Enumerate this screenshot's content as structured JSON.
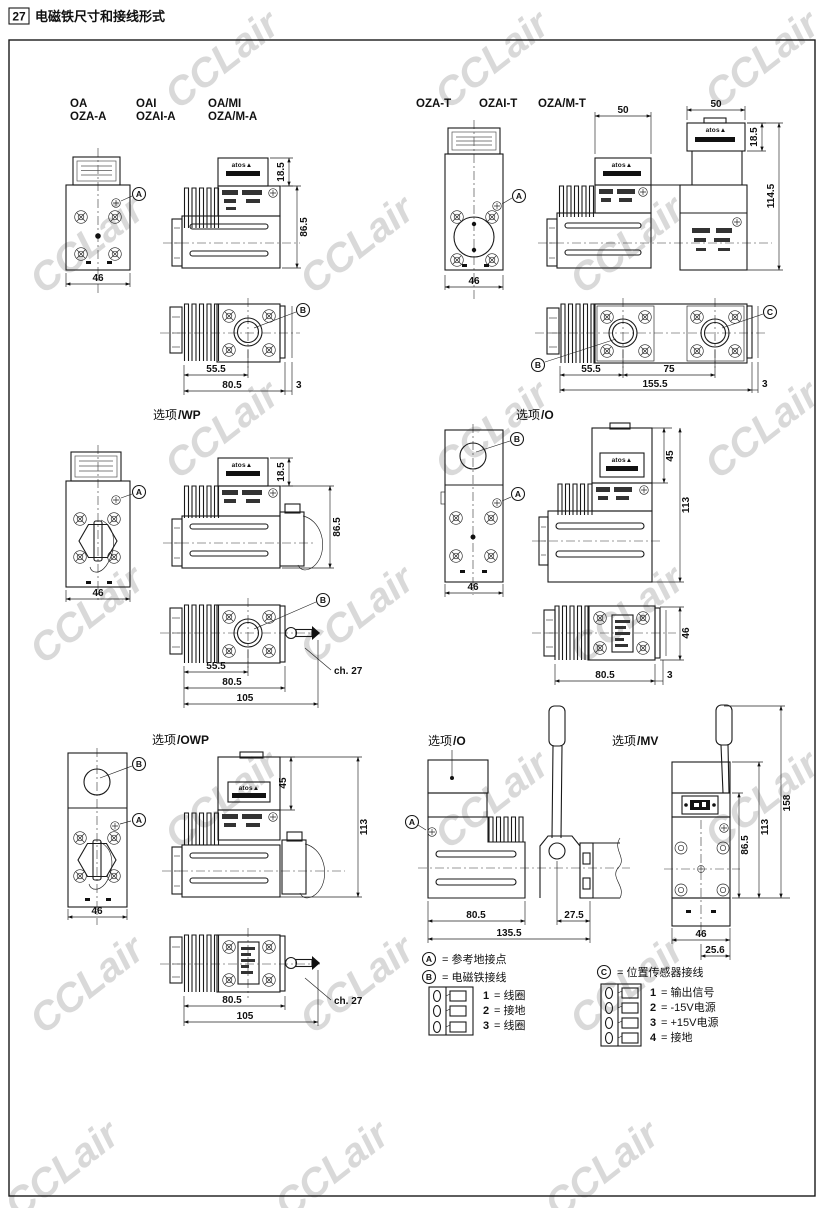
{
  "page": {
    "number": "27",
    "title": "电磁铁尺寸和接线形式",
    "watermark": "CCLair",
    "brand": "atos▲"
  },
  "models": {
    "left_row1": [
      "OA",
      "OAI",
      "OA/MI"
    ],
    "left_row2": [
      "OZA-A",
      "OZAI-A",
      "OZA/M-A"
    ],
    "right": [
      "OZA-T",
      "OZAI-T",
      "OZA/M-T"
    ]
  },
  "options": {
    "wp": {
      "prefix": "选项",
      "suffix": "/WP"
    },
    "o": {
      "prefix": "选项",
      "suffix": "/O"
    },
    "owp": {
      "prefix": "选项",
      "suffix": "/OWP"
    },
    "mv": {
      "prefix": "选项",
      "suffix": "/MV"
    }
  },
  "callouts": {
    "a": "A",
    "b": "B",
    "c": "C"
  },
  "dims": {
    "w46": "46",
    "h18_5": "18.5",
    "h86_5": "86.5",
    "l55_5": "55.5",
    "l80_5": "80.5",
    "t3": "3",
    "w50": "50",
    "h114_5": "114.5",
    "l75": "75",
    "l155_5": "155.5",
    "l105": "105",
    "ch27": "ch. 27",
    "h45": "45",
    "h113": "113",
    "l27_5": "27.5",
    "l135_5": "135.5",
    "h158": "158",
    "w25_6": "25.6"
  },
  "legend": {
    "a": {
      "label": "A",
      "text": "=  参考地接点"
    },
    "b": {
      "label": "B",
      "text": "=  电磁铁接线",
      "pins": [
        {
          "n": "1",
          "t": "=  线圈"
        },
        {
          "n": "2",
          "t": "=  接地"
        },
        {
          "n": "3",
          "t": "=  线圈"
        }
      ]
    },
    "c": {
      "label": "C",
      "text": "=  位置传感器接线",
      "pins": [
        {
          "n": "1",
          "t": "=  输出信号"
        },
        {
          "n": "2",
          "t": "=  -15V电源"
        },
        {
          "n": "3",
          "t": "=  +15V电源"
        },
        {
          "n": "4",
          "t": "=  接地"
        }
      ]
    }
  }
}
